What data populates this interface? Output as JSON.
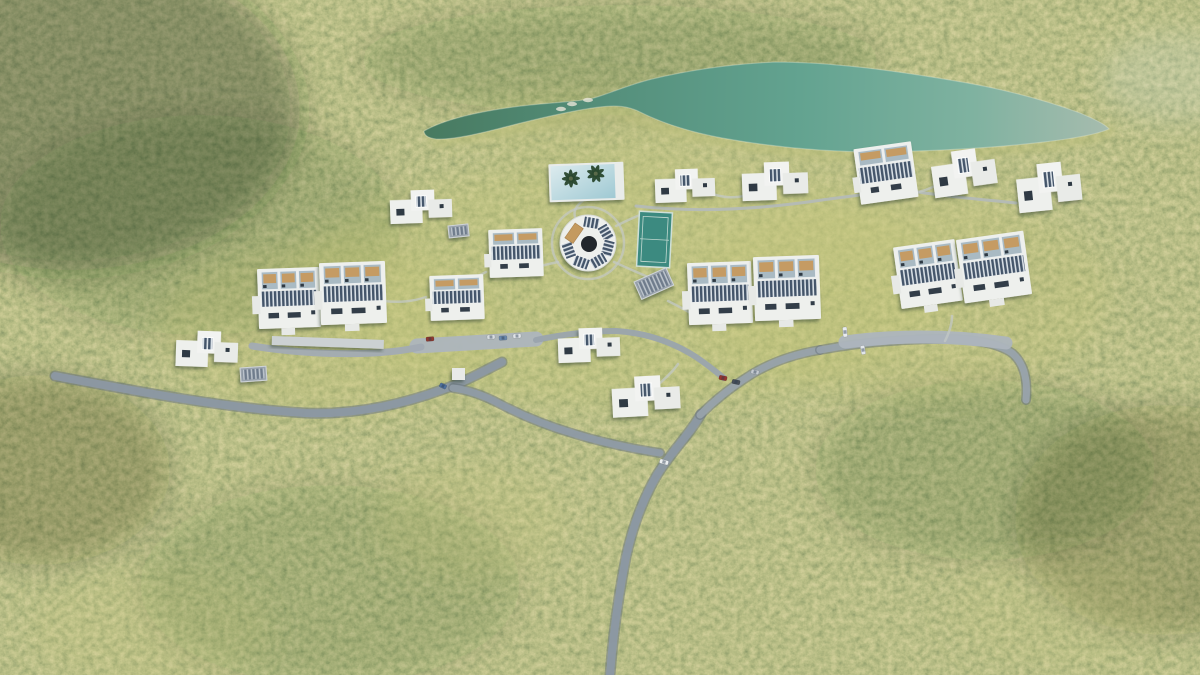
{
  "scene": {
    "canvas": {
      "w": 1200,
      "h": 675
    },
    "palette": {
      "forest_base": "#87914f",
      "forest_dark": "#3f5234",
      "forest_light": "#c6c489",
      "lake_dark": "#47795f",
      "lake_teal": "#63a390",
      "lake_pale": "#a7bcae",
      "road_gray": "#8c98a3",
      "parking_gray": "#adb5bd",
      "walkway_gray": "#c3c8c4",
      "building_white": "#eef0ed",
      "solar_dark": "#44556a",
      "window_dark": "#333e49",
      "patio_tan": "#c59b63",
      "pool_blue": "#aed2db",
      "tennis_teal": "#3c8a80"
    },
    "terrain": {
      "light_patches": [
        {
          "x": 620,
          "y": 285,
          "rx": 330,
          "ry": 120,
          "c": "rgba(196,198,120,0.30)"
        },
        {
          "x": 330,
          "y": 330,
          "rx": 170,
          "ry": 85,
          "c": "rgba(196,198,120,0.26)"
        },
        {
          "x": 900,
          "y": 295,
          "rx": 210,
          "ry": 100,
          "c": "rgba(196,198,120,0.26)"
        },
        {
          "x": 780,
          "y": 200,
          "rx": 240,
          "ry": 70,
          "c": "rgba(200,202,128,0.24)"
        },
        {
          "x": 585,
          "y": 128,
          "rx": 120,
          "ry": 40,
          "c": "rgba(196,198,120,0.20)"
        },
        {
          "x": 470,
          "y": 520,
          "rx": 95,
          "ry": 60,
          "c": "rgba(198,200,124,0.18)"
        },
        {
          "x": 150,
          "y": 628,
          "rx": 120,
          "ry": 60,
          "c": "rgba(198,200,124,0.16)"
        },
        {
          "x": 1058,
          "y": 612,
          "rx": 110,
          "ry": 55,
          "c": "rgba(198,200,124,0.13)"
        },
        {
          "x": 1180,
          "y": 78,
          "rx": 80,
          "ry": 45,
          "c": "rgba(205,214,205,0.25)"
        }
      ],
      "dark_patches": [
        {
          "x": 70,
          "y": 110,
          "rx": 230,
          "ry": 160,
          "c": "rgba(28,42,24,0.32)"
        },
        {
          "x": 200,
          "y": 225,
          "rx": 200,
          "ry": 110,
          "c": "rgba(28,42,24,0.14)"
        },
        {
          "x": 40,
          "y": 470,
          "rx": 130,
          "ry": 95,
          "c": "rgba(28,42,24,0.22)"
        },
        {
          "x": 1165,
          "y": 520,
          "rx": 150,
          "ry": 115,
          "c": "rgba(28,42,24,0.20)"
        },
        {
          "x": 330,
          "y": 585,
          "rx": 190,
          "ry": 100,
          "c": "rgba(28,42,24,0.12)"
        },
        {
          "x": 985,
          "y": 470,
          "rx": 170,
          "ry": 90,
          "c": "rgba(28,42,24,0.14)"
        },
        {
          "x": 620,
          "y": 60,
          "rx": 260,
          "ry": 55,
          "c": "rgba(28,42,24,0.15)"
        }
      ]
    },
    "lake": {
      "id": "lake",
      "d": "M 424 131 C 450 116, 500 107, 552 103 C 572 101, 586 101, 600 96 C 618 90, 632 84, 652 79 C 690 70, 730 64, 775 62 C 830 62, 890 70, 950 80 C 1000 88, 1045 100, 1080 113 C 1094 119, 1105 124, 1109 129 C 1098 134, 1072 139, 1035 143 C 990 148, 935 151, 878 152 C 825 152, 772 147, 722 138 C 690 132, 662 123, 640 112 C 628 106, 616 105, 600 107 C 575 110, 540 118, 505 127 C 478 134, 452 140, 436 139 C 428 138, 424 135, 424 131 Z",
      "shore_d": "M 436 142 C 500 132, 560 118, 612 110 C 640 121, 680 133, 722 141 C 776 150, 830 155, 882 155 C 936 155, 996 151, 1042 145 C 1076 141, 1098 136, 1108 130",
      "gradient": [
        "#47795f",
        "#55907c",
        "#63a390",
        "#7fb2a0",
        "#a7bcae"
      ],
      "rocks": [
        [
          572,
          104
        ],
        [
          588,
          100
        ],
        [
          561,
          109
        ]
      ]
    },
    "roads": [
      {
        "id": "road-west",
        "d": "M 55 376 C 140 392, 225 408, 305 413 C 352 415, 398 406, 444 389 C 464 382, 482 372, 502 362",
        "w": 8,
        "c": "#8c98a3",
        "edge": true
      },
      {
        "id": "road-south",
        "d": "M 701 414 C 690 434, 671 452, 657 475 C 643 499, 633 525, 626 557 C 619 593, 613 635, 610 675",
        "w": 8,
        "c": "#8c98a3",
        "edge": true
      },
      {
        "id": "road-south-branch",
        "d": "M 660 453 C 634 449, 604 443, 575 434 C 551 427, 525 417, 500 404 C 483 395, 468 390, 453 388",
        "w": 7,
        "c": "#8f9ba5",
        "edge": true
      },
      {
        "id": "road-center-link",
        "d": "M 700 415 C 714 401, 731 387, 752 374 C 772 362, 795 354, 820 350",
        "w": 7,
        "c": "#98a2ab",
        "edge": true
      },
      {
        "id": "road-east",
        "d": "M 820 350 C 852 344, 891 340, 931 339 C 966 338, 996 342, 1012 353 C 1024 363, 1028 379, 1026 400",
        "w": 7,
        "c": "#99a3ac",
        "edge": true
      },
      {
        "id": "parking-west",
        "d": "M 417 346 L 536 339",
        "w": 15,
        "c": "#adb5bd",
        "edge": false
      },
      {
        "id": "parking-east",
        "d": "M 845 342 C 890 336, 942 334, 1006 343",
        "w": 13,
        "c": "#adb5bd",
        "edge": false
      },
      {
        "id": "road-mid-link",
        "d": "M 536 340 C 560 335, 588 331, 616 331 C 648 333, 674 343, 696 357 C 708 365, 716 372, 724 378",
        "w": 6,
        "c": "#9aa4ad",
        "edge": false
      },
      {
        "id": "drive-left-cluster",
        "d": "M 252 346 C 290 352, 332 355, 374 353 C 392 352, 407 350, 421 347",
        "w": 7,
        "c": "#a2abb3",
        "edge": false
      },
      {
        "id": "path-top-villas",
        "d": "M 636 206 C 698 213, 762 209, 822 200 C 852 196, 880 192, 906 190 C 940 196, 978 199, 1016 203",
        "w": 3,
        "c": "#b4bab6",
        "edge": false
      }
    ],
    "walkways": [
      {
        "id": "walkway-pool",
        "d": "M 585 199 C 577 205, 573 210, 575 217"
      },
      {
        "id": "walkway-amphitheater-ring",
        "circle": [
          588,
          243,
          36
        ]
      },
      {
        "id": "walkway-east-1",
        "d": "M 614 262 C 640 274, 652 278, 665 285"
      },
      {
        "id": "walkway-east-2",
        "d": "M 668 301 C 680 307, 686 310, 692 314"
      },
      {
        "id": "walkway-west",
        "d": "M 558 262 C 548 264, 540 266, 532 269"
      },
      {
        "id": "walkway-tennis",
        "d": "M 616 226 C 626 221, 632 218, 640 215"
      },
      {
        "id": "walkway-villa-2",
        "d": "M 712 194 C 726 198, 734 198, 744 196"
      },
      {
        "id": "walkway-villa-4",
        "d": "M 914 193 C 924 191, 929 189, 935 186"
      },
      {
        "id": "walkway-block-r",
        "d": "M 952 316 C 952 325, 949 333, 945 341"
      },
      {
        "id": "walkway-left-cluster",
        "d": "M 384 301 C 402 303, 414 301, 426 297"
      },
      {
        "id": "walkway-villa-8",
        "d": "M 660 383 C 668 376, 674 370, 678 364"
      },
      {
        "id": "walkway-m1-m2",
        "d": "M 486 272 C 476 277, 468 282, 460 287"
      }
    ],
    "amenities": {
      "pool": {
        "id": "swimming-pool",
        "x": 551,
        "y": 165,
        "w": 71,
        "h": 34,
        "rot": -2,
        "water": [
          "#dcebee",
          "#9fc9d3"
        ],
        "palms": [
          [
            20,
            13
          ],
          [
            45,
            9
          ]
        ]
      },
      "tennis": {
        "id": "tennis-court",
        "x": 638,
        "y": 212,
        "w": 33,
        "h": 55,
        "rot": 3,
        "fill": "#3c8a80",
        "line": "#c2d9d0"
      },
      "amphitheater": {
        "id": "amphitheater",
        "cx": 588,
        "cy": 243,
        "r": 28,
        "panel_angles": [
          10,
          60,
          105,
          150,
          200,
          250
        ],
        "seating_angle": 305,
        "hole": "#22272c",
        "seating": "#c49a5f"
      },
      "solar_arrays": [
        {
          "id": "ground-solar-1",
          "x": 634,
          "y": 282,
          "w": 35,
          "h": 19,
          "rot": -24
        },
        {
          "id": "ground-solar-2",
          "x": 448,
          "y": 226,
          "w": 20,
          "h": 12,
          "rot": -6
        },
        {
          "id": "ground-solar-3",
          "x": 240,
          "y": 368,
          "w": 26,
          "h": 14,
          "rot": -4
        }
      ],
      "structures": [
        {
          "id": "carport-strip",
          "x": 272,
          "y": 336,
          "w": 112,
          "h": 9,
          "rot": 2,
          "fill": "#ccd1d3"
        },
        {
          "id": "utility-shed",
          "x": 452,
          "y": 368,
          "w": 13,
          "h": 12,
          "rot": 0,
          "fill": "#e8eae8"
        }
      ]
    },
    "buildings": {
      "blocks": [
        {
          "id": "residence-block-l1",
          "x": 258,
          "y": 268,
          "w": 62,
          "h": 60,
          "rot": -2
        },
        {
          "id": "residence-block-l2",
          "x": 320,
          "y": 262,
          "w": 66,
          "h": 62,
          "rot": -2
        },
        {
          "id": "residence-block-c1",
          "x": 688,
          "y": 262,
          "w": 64,
          "h": 62,
          "rot": -2
        },
        {
          "id": "residence-block-c2",
          "x": 754,
          "y": 256,
          "w": 66,
          "h": 64,
          "rot": -2
        },
        {
          "id": "residence-block-r1",
          "x": 897,
          "y": 243,
          "w": 62,
          "h": 62,
          "rot": -8
        },
        {
          "id": "residence-block-r2",
          "x": 960,
          "y": 235,
          "w": 68,
          "h": 64,
          "rot": -8
        }
      ],
      "solarhouses": [
        {
          "id": "solar-house-1",
          "x": 489,
          "y": 229,
          "w": 54,
          "h": 48,
          "rot": -2
        },
        {
          "id": "solar-house-2",
          "x": 430,
          "y": 275,
          "w": 54,
          "h": 45,
          "rot": -2
        },
        {
          "id": "solar-house-3",
          "x": 857,
          "y": 145,
          "w": 58,
          "h": 56,
          "rot": -8
        }
      ],
      "villas": [
        {
          "id": "villa-1",
          "x": 390,
          "y": 190,
          "w": 62,
          "h": 33,
          "rot": -2
        },
        {
          "id": "villa-2",
          "x": 655,
          "y": 169,
          "w": 60,
          "h": 33,
          "rot": -2
        },
        {
          "id": "villa-3",
          "x": 742,
          "y": 162,
          "w": 66,
          "h": 38,
          "rot": -2
        },
        {
          "id": "villa-4",
          "x": 932,
          "y": 150,
          "w": 64,
          "h": 44,
          "rot": -8
        },
        {
          "id": "villa-5",
          "x": 1017,
          "y": 163,
          "w": 64,
          "h": 47,
          "rot": -6
        },
        {
          "id": "villa-6",
          "x": 176,
          "y": 331,
          "w": 62,
          "h": 36,
          "rot": 2
        },
        {
          "id": "villa-7",
          "x": 558,
          "y": 328,
          "w": 62,
          "h": 34,
          "rot": -2
        },
        {
          "id": "villa-8",
          "x": 612,
          "y": 376,
          "w": 68,
          "h": 40,
          "rot": -3
        }
      ]
    },
    "cars": [
      {
        "id": "car-1",
        "x": 430,
        "y": 339,
        "c": "#8e3a30",
        "rot": -5,
        "l": 8
      },
      {
        "id": "car-2",
        "x": 491,
        "y": 337,
        "c": "#d7dce0",
        "rot": -3,
        "l": 8
      },
      {
        "id": "car-3",
        "x": 503,
        "y": 338,
        "c": "#6a88ab",
        "rot": -3,
        "l": 8
      },
      {
        "id": "car-4",
        "x": 517,
        "y": 336,
        "c": "#dfe3e7",
        "rot": -3,
        "l": 8
      },
      {
        "id": "car-5",
        "x": 443,
        "y": 386,
        "c": "#4d6f9d",
        "rot": 25,
        "l": 7
      },
      {
        "id": "car-6",
        "x": 664,
        "y": 462,
        "c": "#eceff1",
        "rot": 15,
        "l": 9
      },
      {
        "id": "car-7",
        "x": 723,
        "y": 378,
        "c": "#97362e",
        "rot": 12,
        "l": 8
      },
      {
        "id": "car-8",
        "x": 736,
        "y": 382,
        "c": "#474f58",
        "rot": 12,
        "l": 8
      },
      {
        "id": "car-9",
        "x": 755,
        "y": 372,
        "c": "#c4cad0",
        "rot": 12,
        "l": 8
      },
      {
        "id": "car-10",
        "x": 845,
        "y": 332,
        "c": "#e8ebee",
        "rot": 85,
        "l": 10
      },
      {
        "id": "car-11",
        "x": 863,
        "y": 350,
        "c": "#e2e6ea",
        "rot": 80,
        "l": 9
      }
    ]
  }
}
